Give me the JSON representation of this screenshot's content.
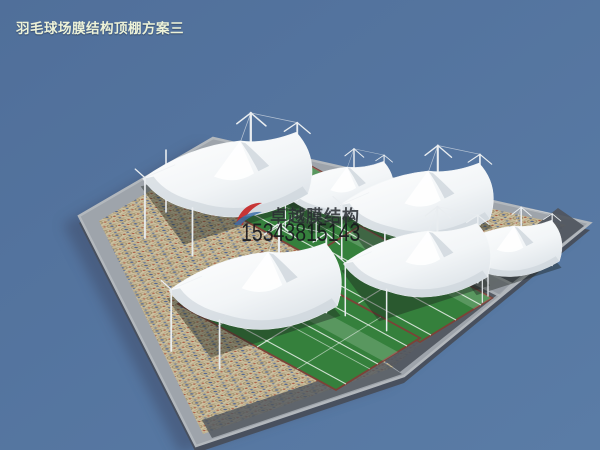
{
  "title": {
    "text": "羽毛球场膜结构顶棚方案三"
  },
  "watermark": {
    "brand": "卓越膜结构",
    "phone": "15343815143",
    "logo": "red-blue-swoosh-logo"
  },
  "scene": {
    "subject": "membrane-canopy-badminton-courts-3d-render",
    "canopy_count": 6,
    "court_rows": 3
  },
  "colors": {
    "bg": "#506F9A",
    "bgLight": "#5A7CA6",
    "halo": "#3C4A66",
    "slab": "#9EA4AB",
    "slabSide": "#48505E",
    "curb": "#B3B8BD",
    "walk": "#4F555D",
    "mosaic": "#CCBF9F",
    "green": "#35803C",
    "line": "#EAF0EA",
    "edging": "#7C4237",
    "sailShade": "#C9D2D9",
    "mast": "#E9EDF0",
    "shadow": "#1C2420",
    "title": "#EDF2D8",
    "brand": "#2A2E33",
    "phone": "#17191D",
    "logoRed": "#C62828",
    "logoBlue": "#3A6EA8"
  }
}
